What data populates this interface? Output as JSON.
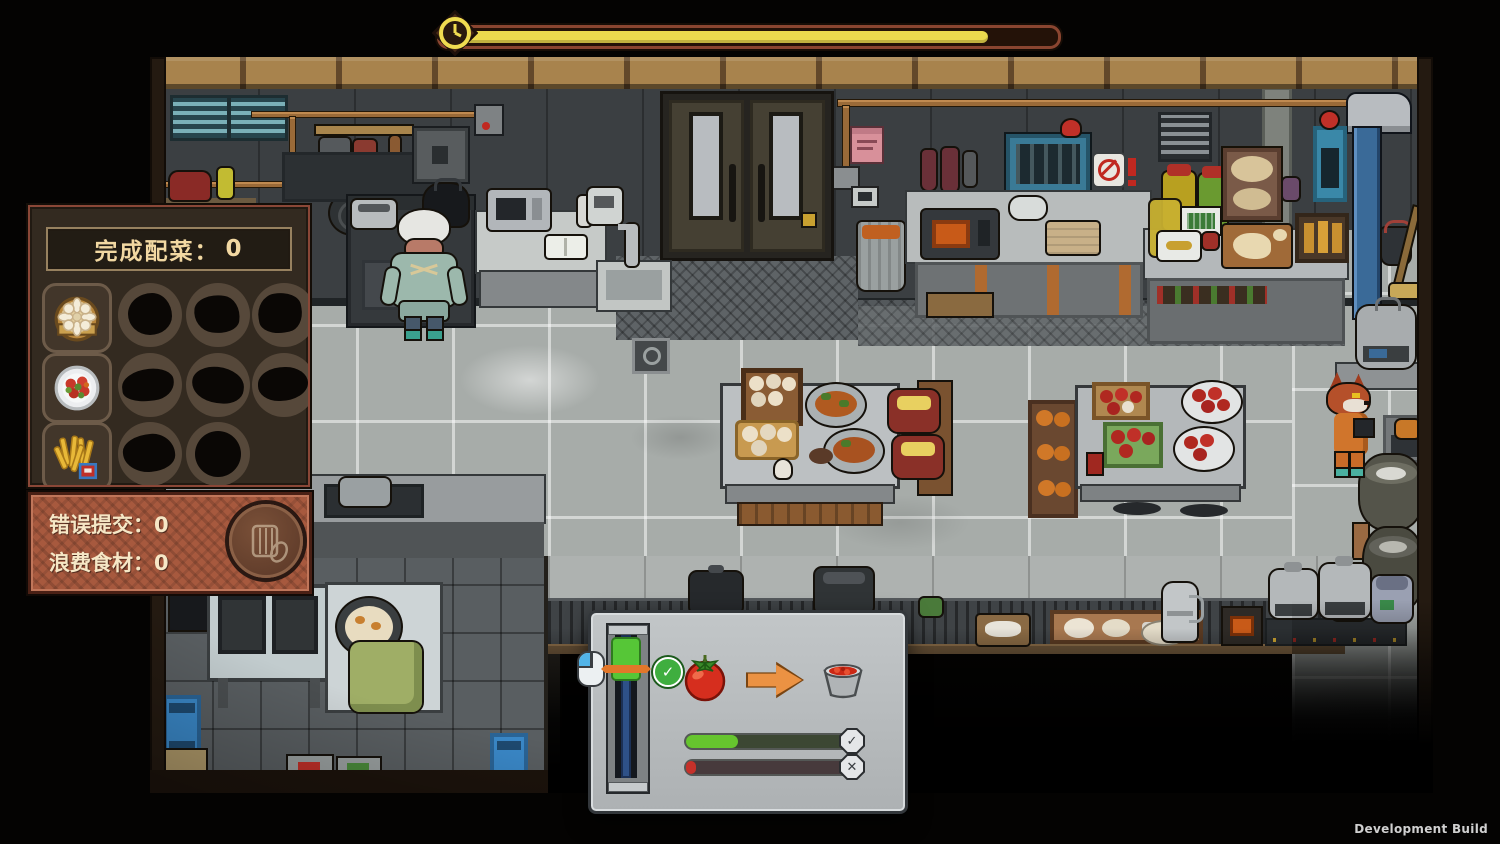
{
  "build_label": "Development Build",
  "timer": {
    "icon": "clock-icon",
    "progress_pct": 88,
    "fill_color": "#ecd94e"
  },
  "completed_panel": {
    "title_label": "完成配菜：",
    "title_value": "0",
    "rows": [
      {
        "icon": "steamer-dumplings-icon",
        "pending_slots": 3
      },
      {
        "icon": "tomato-salad-plate-icon",
        "pending_slots": 3
      },
      {
        "icon": "fries-icon",
        "pending_slots": 2
      }
    ]
  },
  "stats_panel": {
    "icon": "waste-bin-icon",
    "rows": [
      {
        "label": "错误提交：",
        "value": "0"
      },
      {
        "label": "浪费食材：",
        "value": "0"
      }
    ]
  },
  "minigame": {
    "mouse_hint_icon": "mouse-left-click-icon",
    "gauge": {
      "zone_top_pct": 1.5,
      "zone_height_pct": 28,
      "needle_top_pct": 21,
      "zone_color": "#56c637",
      "needle_color": "#e2772a",
      "status_icon": "check-circle-icon"
    },
    "conversion": {
      "from_icon": "tomato-icon",
      "arrow_icon": "arrow-right-icon",
      "to_icon": "tomato-sauce-bowl-icon"
    },
    "bars": [
      {
        "name": "success",
        "fill_pct": 31,
        "fill_color": "#66c52e",
        "badge": "check"
      },
      {
        "name": "fail",
        "fill_pct": 6,
        "fill_color": "#c5312a",
        "badge": "cross"
      }
    ]
  },
  "glyphs": {
    "check": "✓",
    "cross": "✕"
  },
  "scene": {
    "characters": [
      "chef-cook",
      "fox-inmate"
    ]
  }
}
